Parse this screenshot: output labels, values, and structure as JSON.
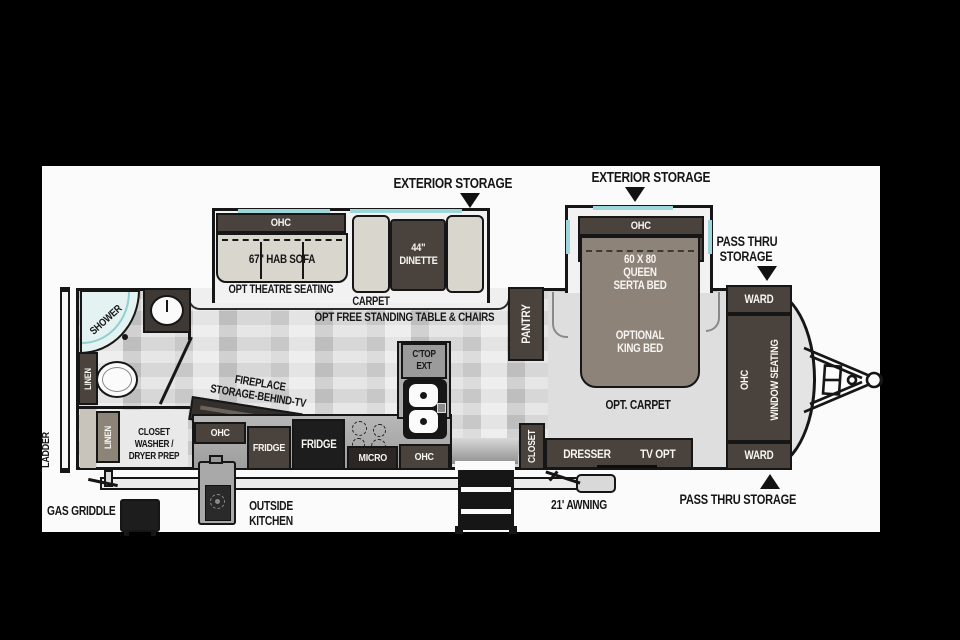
{
  "colors": {
    "background": "#000000",
    "canvas": "#fbfbfb",
    "wall": "#161616",
    "cabinet_brown": "#4a423d",
    "cabinet_black": "#1d1d1d",
    "bed_taupe": "#8e8379",
    "cushion_light": "#d9d6ce",
    "window_teal": "#9ed7db",
    "floor_gray": "#d4d4d4",
    "shower_teal": "#e4f2f1"
  },
  "callouts": {
    "exterior_storage_left": "EXTERIOR STORAGE",
    "exterior_storage_right": "EXTERIOR STORAGE",
    "pass_thru_top_line1": "PASS THRU",
    "pass_thru_top_line2": "STORAGE",
    "pass_thru_bottom": "PASS THRU STORAGE",
    "awning": "21' AWNING",
    "outside_kitchen_line1": "OUTSIDE",
    "outside_kitchen_line2": "KITCHEN",
    "gas_griddle": "GAS GRIDDLE",
    "ladder": "LADDER"
  },
  "living": {
    "ohc": "OHC",
    "sofa": "67\" HAB SOFA",
    "theatre_seating": "OPT THEATRE SEATING",
    "dinette_line1": "44\"",
    "dinette_line2": "DINETTE",
    "carpet": "CARPET",
    "free_standing": "OPT FREE STANDING TABLE & CHAIRS",
    "fireplace_line1": "FIREPLACE",
    "fireplace_line2": "STORAGE-BEHIND-TV"
  },
  "kitchen": {
    "ohc_left": "OHC",
    "fridge_1": "FRIDGE",
    "fridge_2": "FRIDGE",
    "micro": "MICRO",
    "ohc_right": "OHC",
    "ctop_line1": "C'TOP",
    "ctop_line2": "EXT",
    "pantry": "PANTRY"
  },
  "bedroom": {
    "ohc": "OHC",
    "bed_line1": "60 X 80",
    "bed_line2": "QUEEN",
    "bed_line3": "SERTA BED",
    "king_line1": "OPTIONAL",
    "king_line2": "KING BED",
    "opt_carpet": "OPT. CARPET",
    "dresser": "DRESSER",
    "tv_opt": "TV OPT",
    "closet": "CLOSET"
  },
  "front": {
    "ward_top": "WARD",
    "ward_bottom": "WARD",
    "ohc": "OHC",
    "window_seating": "WINDOW SEATING"
  },
  "bath": {
    "shower": "SHOWER",
    "linen_upper": "LINEN",
    "linen_lower": "LINEN",
    "wd_line1": "CLOSET",
    "wd_line2": "WASHER /",
    "wd_line3": "DRYER PREP"
  }
}
